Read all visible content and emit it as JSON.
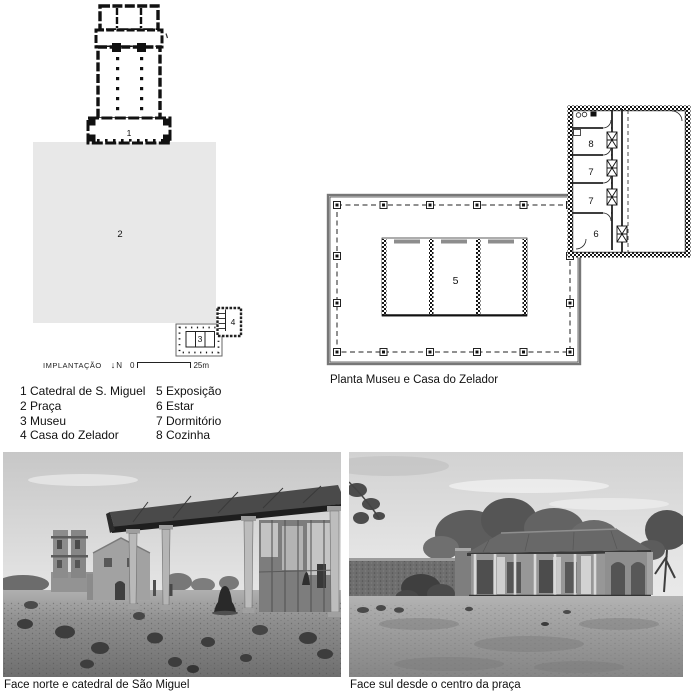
{
  "site_plan": {
    "scale_label": "IMPLANTAÇÃO",
    "north_arrow_icon": "↓",
    "north_label": "N",
    "scale_start": "0",
    "scale_end": "25m",
    "num_cathedral": "1",
    "num_praca": "2",
    "num_museu": "3",
    "num_zelador": "4"
  },
  "legend": {
    "items": [
      "1 Catedral de S. Miguel",
      "2 Praça",
      "3 Museu",
      "4 Casa do Zelador",
      "5 Exposição",
      "6 Estar",
      "7 Dormitório",
      "8 Cozinha"
    ]
  },
  "floor_plan": {
    "caption": "Planta Museu e Casa do Zelador",
    "num_exposicao": "5",
    "num_estar": "6",
    "num_dormitorio_1": "7",
    "num_dormitorio_2": "7",
    "num_cozinha": "8"
  },
  "photos": {
    "left_caption": "Face norte e catedral de São Miguel",
    "right_caption": "Face sul desde o centro da praça"
  },
  "colors": {
    "paper": "#ffffff",
    "ink": "#111111",
    "praca_fill": "#e8e8e8",
    "plan_gray_line": "#777777",
    "photo_sky": "#d9d9d9",
    "photo_ground": "#8f8f8f",
    "photo_roof_dark": "#2a2a2a"
  }
}
